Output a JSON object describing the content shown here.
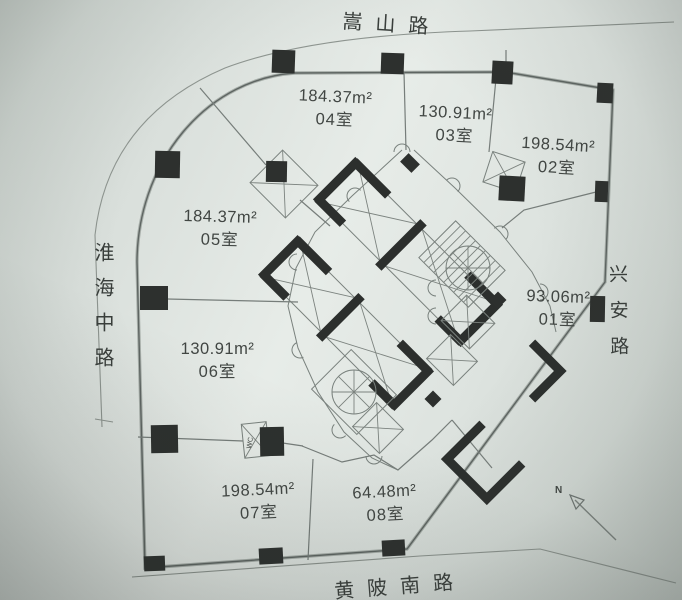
{
  "roads": {
    "top": "嵩山路",
    "left": "淮海中路",
    "right": "兴安路",
    "bottom": "黄陂南路"
  },
  "rooms": [
    {
      "id": "04",
      "area": "184.37m²",
      "label": "04室"
    },
    {
      "id": "03",
      "area": "130.91m²",
      "label": "03室"
    },
    {
      "id": "02",
      "area": "198.54m²",
      "label": "02室"
    },
    {
      "id": "05",
      "area": "184.37m²",
      "label": "05室"
    },
    {
      "id": "01",
      "area": "93.06m²",
      "label": "01室"
    },
    {
      "id": "06",
      "area": "130.91m²",
      "label": "06室"
    },
    {
      "id": "07",
      "area": "198.54m²",
      "label": "07室"
    },
    {
      "id": "08",
      "area": "64.48m²",
      "label": "08室"
    }
  ],
  "annotations": {
    "wc": "WC",
    "north": "N"
  },
  "colors": {
    "paper": "#dfe5e1",
    "line": "#707874",
    "wall": "#2c2f2d",
    "text": "#414643"
  }
}
